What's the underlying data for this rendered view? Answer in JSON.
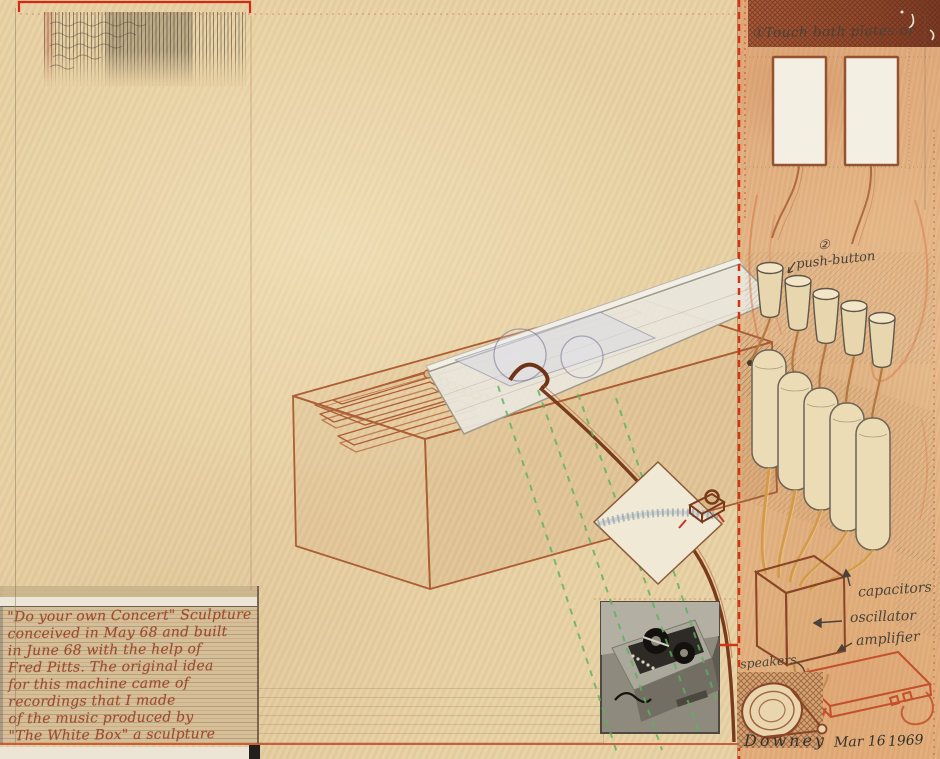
{
  "annotations": {
    "touch_plates": "①Touch both plates or",
    "push_button_number": "②",
    "push_button": "push-button",
    "capacitors": "capacitors",
    "oscillator": "oscillator",
    "amplifier": "amplifier",
    "speakers": "speakers"
  },
  "signature": {
    "name": "Downey",
    "date_month_day": "Mar 16",
    "year": "1969"
  },
  "caption": {
    "lines": [
      "\"Do your own Concert\" Sculpture",
      "conceived in May 68 and built",
      "in June 68 with the help of",
      "Fred Pitts. The original idea",
      "for this machine came of",
      "recordings that I made",
      "of the music produced by",
      "\"The White Box\" a sculpture"
    ]
  },
  "colors": {
    "paper": "#e8d1a3",
    "panel_wash": "#e2ad79",
    "bright_red": "#d23414",
    "sienna_ink": "#a8542c",
    "pencil": "#4a4238",
    "green_dash": "#5cb25c",
    "caption_ink": "#9c4a30"
  }
}
